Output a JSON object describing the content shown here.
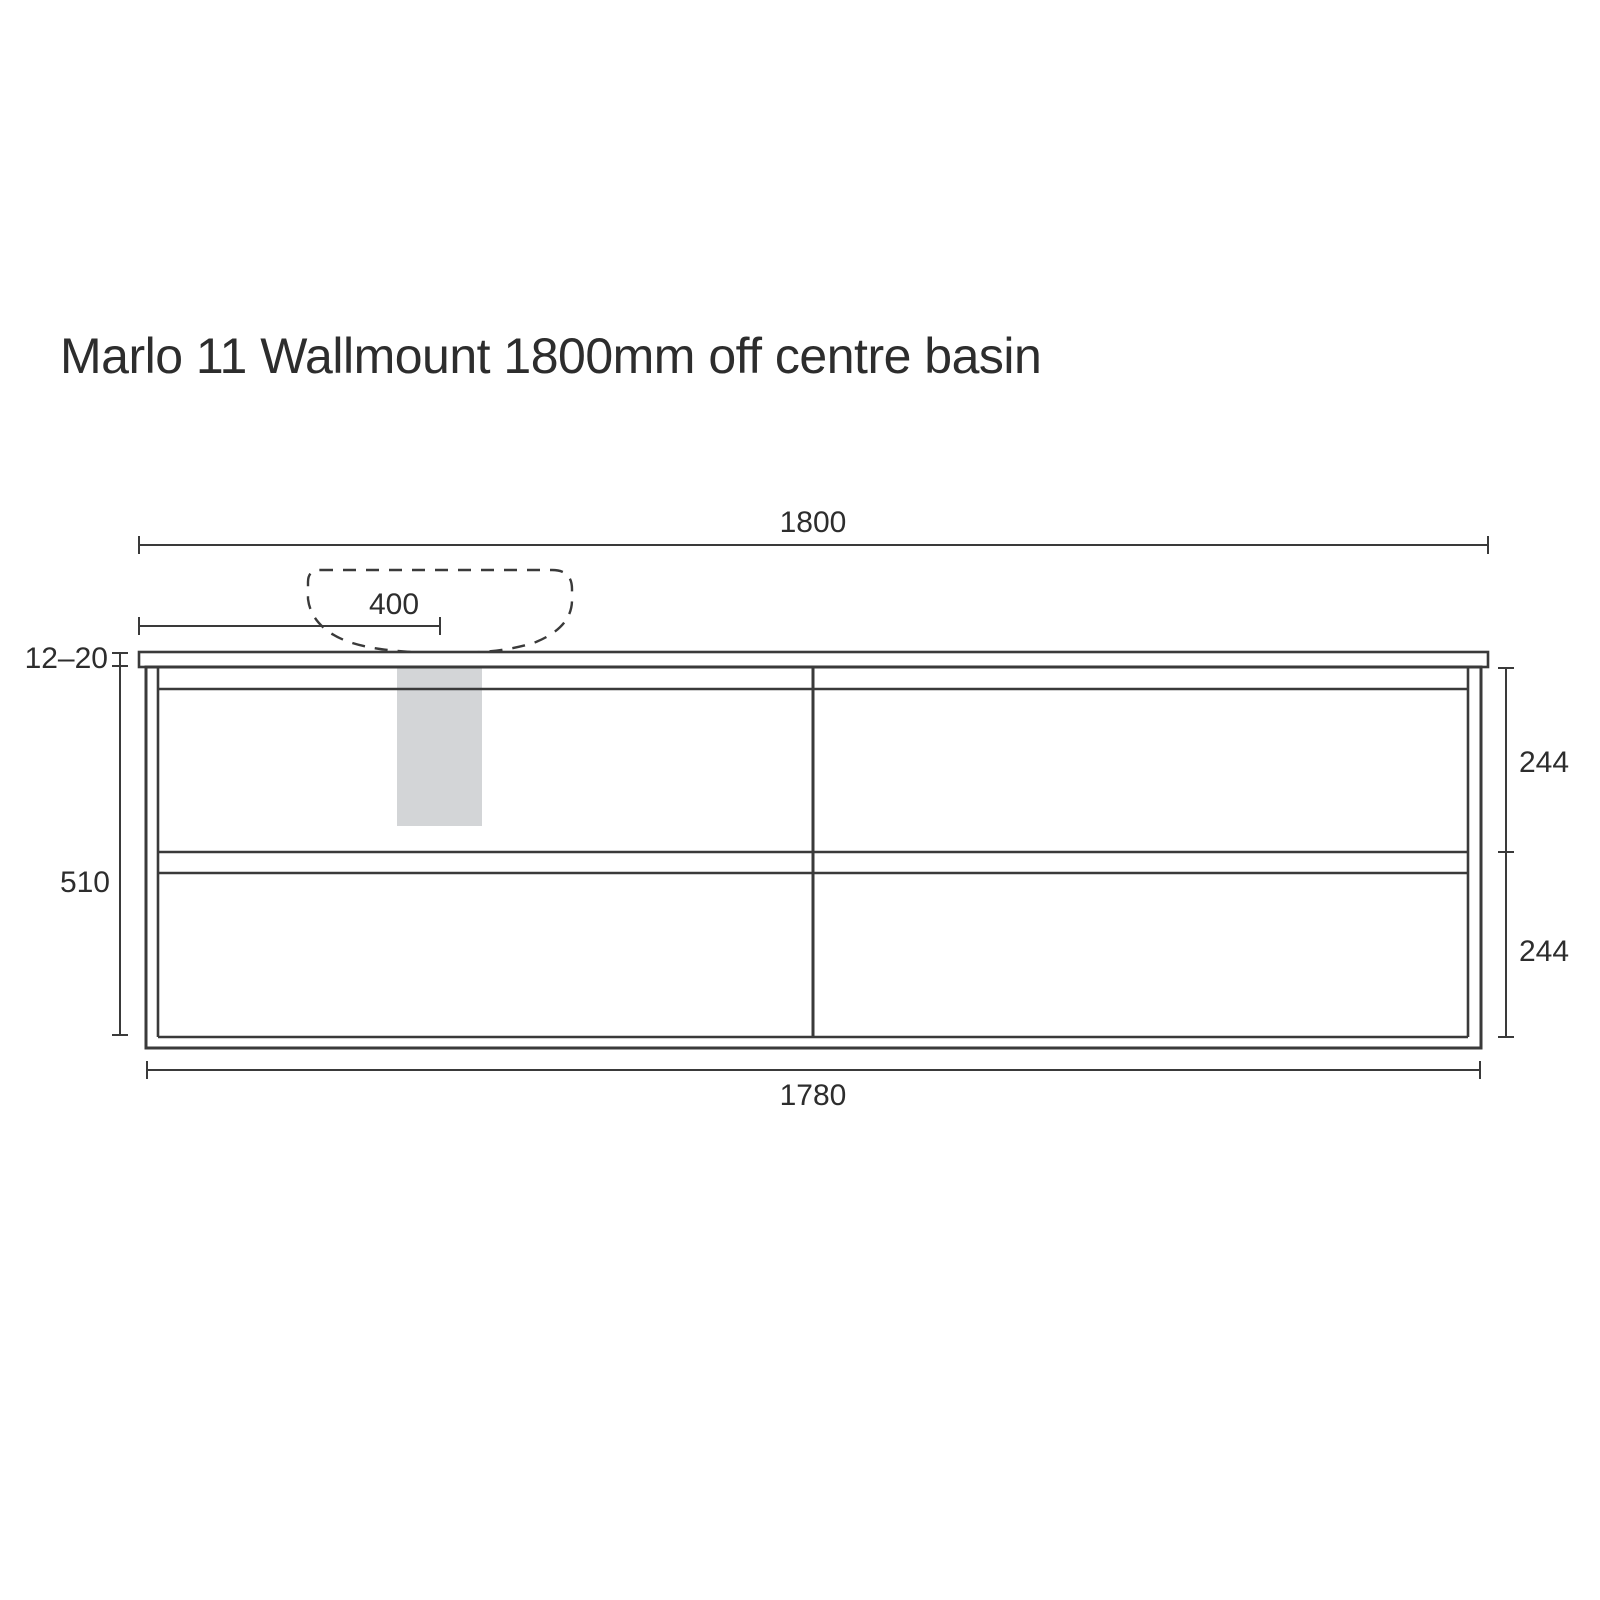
{
  "title": "Marlo 11 Wallmount 1800mm off centre basin",
  "drawing": {
    "view": "front elevation of wall-mounted vanity cabinet with off-centre basin",
    "units": "mm",
    "dims": {
      "overall_width": "1800",
      "basin_centre_from_left": "400",
      "benchtop_thickness_range": "12–20",
      "cabinet_height": "510",
      "top_drawer_front": "244",
      "bottom_drawer_front": "244",
      "cabinet_width": "1780"
    },
    "colors": {
      "line": "#3a3a3a",
      "text": "#2d2d2d",
      "highlight_fill": "#d3d5d7",
      "background": "#ffffff"
    }
  }
}
